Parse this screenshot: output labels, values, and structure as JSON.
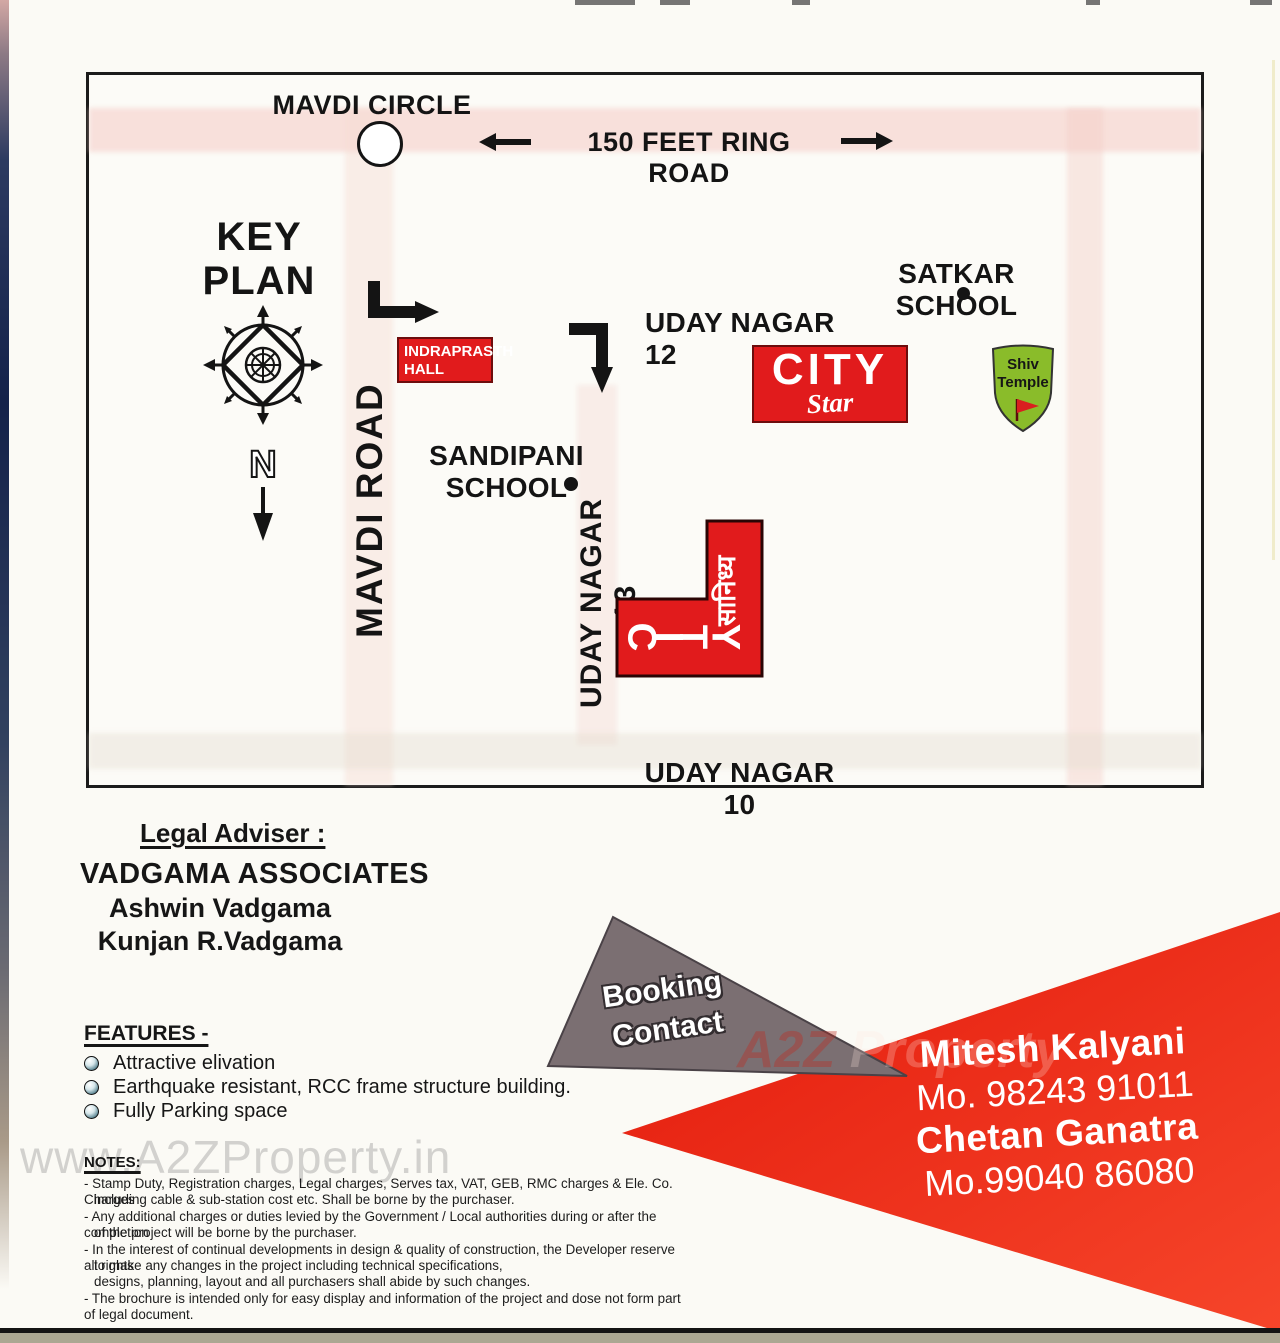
{
  "map": {
    "labels": {
      "mavdi_circle": "MAVDI  CIRCLE",
      "ring_road": "150 FEET RING ROAD",
      "key_plan_line1": "KEY",
      "key_plan_line2": "PLAN",
      "north": "N",
      "mavdi_road": "MAVDI ROAD",
      "uday_nagar_12": "UDAY NAGAR 12",
      "uday_nagar_13": "UDAY NAGAR 13",
      "uday_nagar_10": "UDAY NAGAR 10",
      "satkar_school": "SATKAR SCHOOL",
      "sandipani_line1": "SANDIPANI",
      "sandipani_line2": "SCHOOL",
      "indraprasth_line1": "INDRAPRASTH",
      "indraprasth_line2": "HALL",
      "city_star_line1": "CITY",
      "city_star_line2": "Star",
      "shiv_temple_line1": "Shiv",
      "shiv_temple_line2": "Temple",
      "city_l_letters": [
        "C",
        "I",
        "T",
        "Y"
      ],
      "city_l_hindi": "सानिध्य"
    },
    "colors": {
      "landmark_red": "#e11b1c",
      "temple_green": "#8abc2a",
      "road_pink": "#f4cbc4"
    }
  },
  "legal_adviser": {
    "heading": "Legal Adviser :",
    "firm": "VADGAMA ASSOCIATES",
    "names": [
      "Ashwin Vadgama",
      "Kunjan R.Vadgama"
    ]
  },
  "features": {
    "heading": "FEATURES -",
    "items": [
      "Attractive elivation",
      "Earthquake resistant, RCC frame structure building.",
      "Fully Parking space"
    ]
  },
  "notes": {
    "heading": "NOTES:",
    "lines": [
      "- Stamp Duty, Registration charges, Legal charges, Serves tax, VAT, GEB, RMC charges & Ele. Co. Charges",
      "including cable & sub-station cost etc. Shall be borne by the purchaser.",
      "- Any additional charges or duties levied by the Government / Local authorities during or after the completion",
      "of the project will be borne by the purchaser.",
      "- In the interest of continual developments in design & quality of construction, the Developer reserve all rights",
      "to make any changes in the project including technical specifications,",
      "designs, planning, layout and all purchasers shall abide by such changes.",
      "- The brochure is intended only for easy display and information of the project and dose not form part of legal document."
    ]
  },
  "booking": {
    "label_line1": "Booking",
    "label_line2": "Contact",
    "contacts": [
      {
        "name": "Mitesh Kalyani",
        "phone": "Mo. 98243 91011"
      },
      {
        "name": "Chetan Ganatra",
        "phone": "Mo.99040 86080"
      }
    ],
    "colors": {
      "banner_red": "#ee2d12",
      "banner_gray": "#7b6f72"
    }
  },
  "watermark": {
    "bottom_left": "www.A2ZProperty.in",
    "overlay_a2z": "A2Z",
    "overlay_property": "Property"
  }
}
